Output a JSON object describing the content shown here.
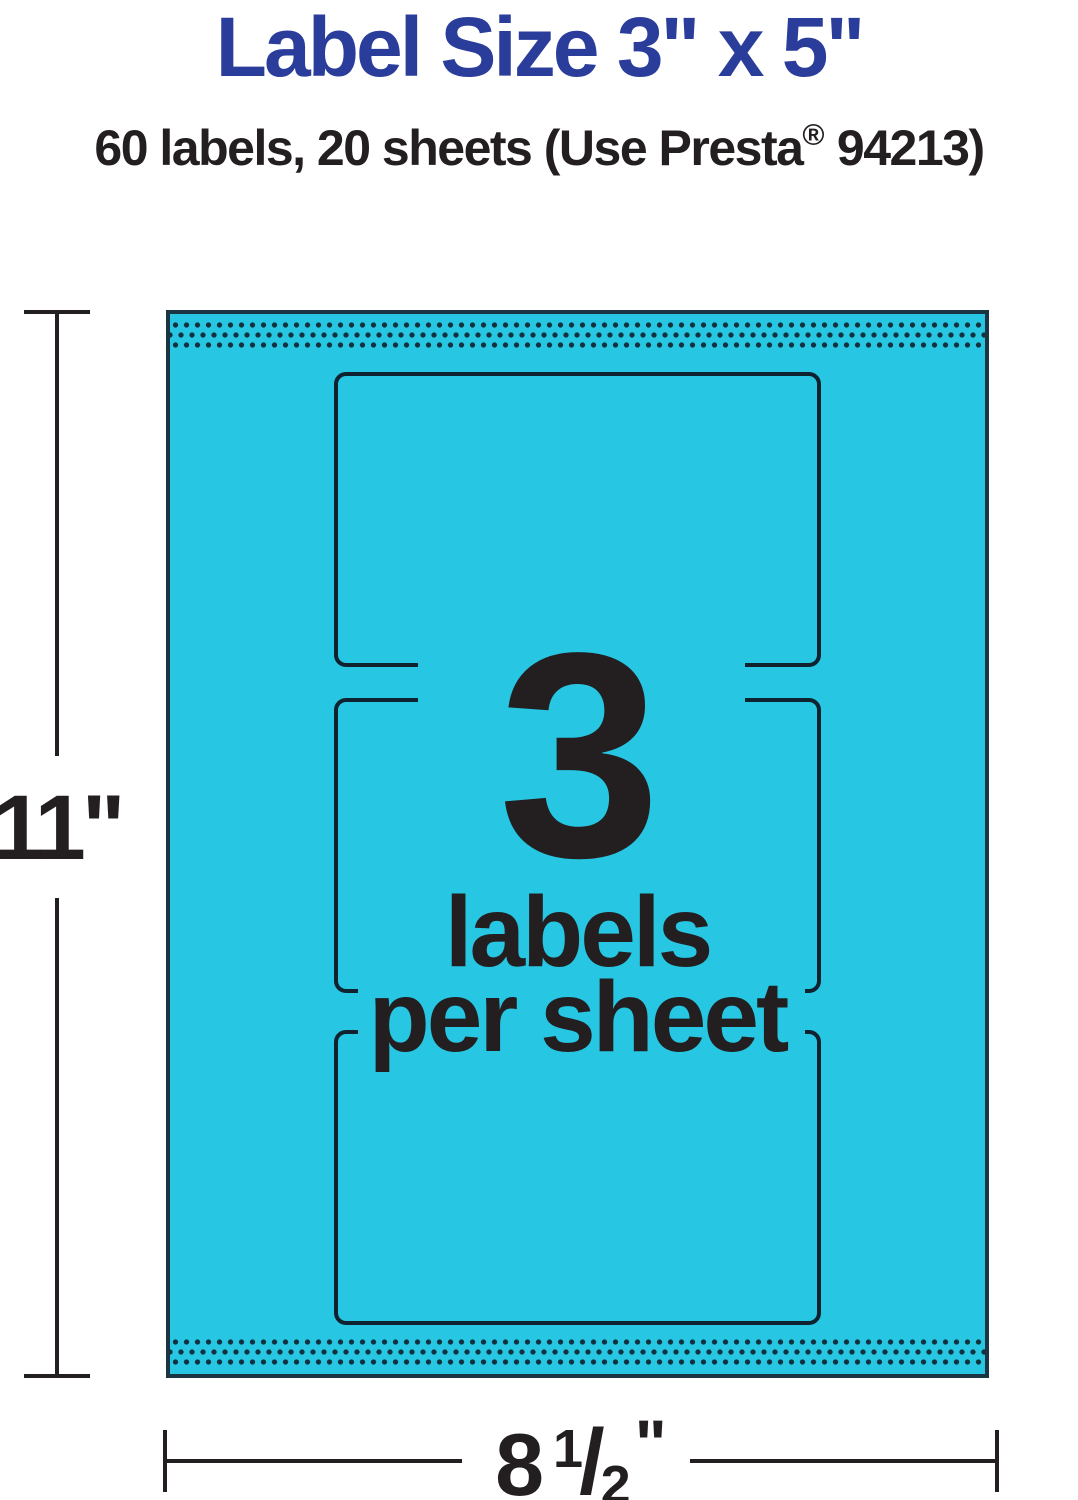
{
  "page": {
    "title": "Label Size 3\" x 5\"",
    "subtitle": {
      "prefix": "60 labels, 20 sheets (Use Presta",
      "registered_mark": "®",
      "suffix": " 94213)"
    }
  },
  "sheet": {
    "count": "3",
    "count_caption_line1": "labels",
    "count_caption_line2": "per sheet",
    "labels_shown": 3
  },
  "dimensions": {
    "height": "11\"",
    "width_whole": "8",
    "width_fraction_numerator": "1",
    "width_fraction_slash": "/",
    "width_fraction_denominator": "2",
    "width_unit_mark": "\""
  },
  "colors": {
    "title_blue": "#2B3D9B",
    "sheet_cyan": "#27C6E2",
    "perforation_dot": "#12313F",
    "label_outline": "#0E2230",
    "text_dark": "#231F20",
    "dimension_line": "#231F20"
  }
}
